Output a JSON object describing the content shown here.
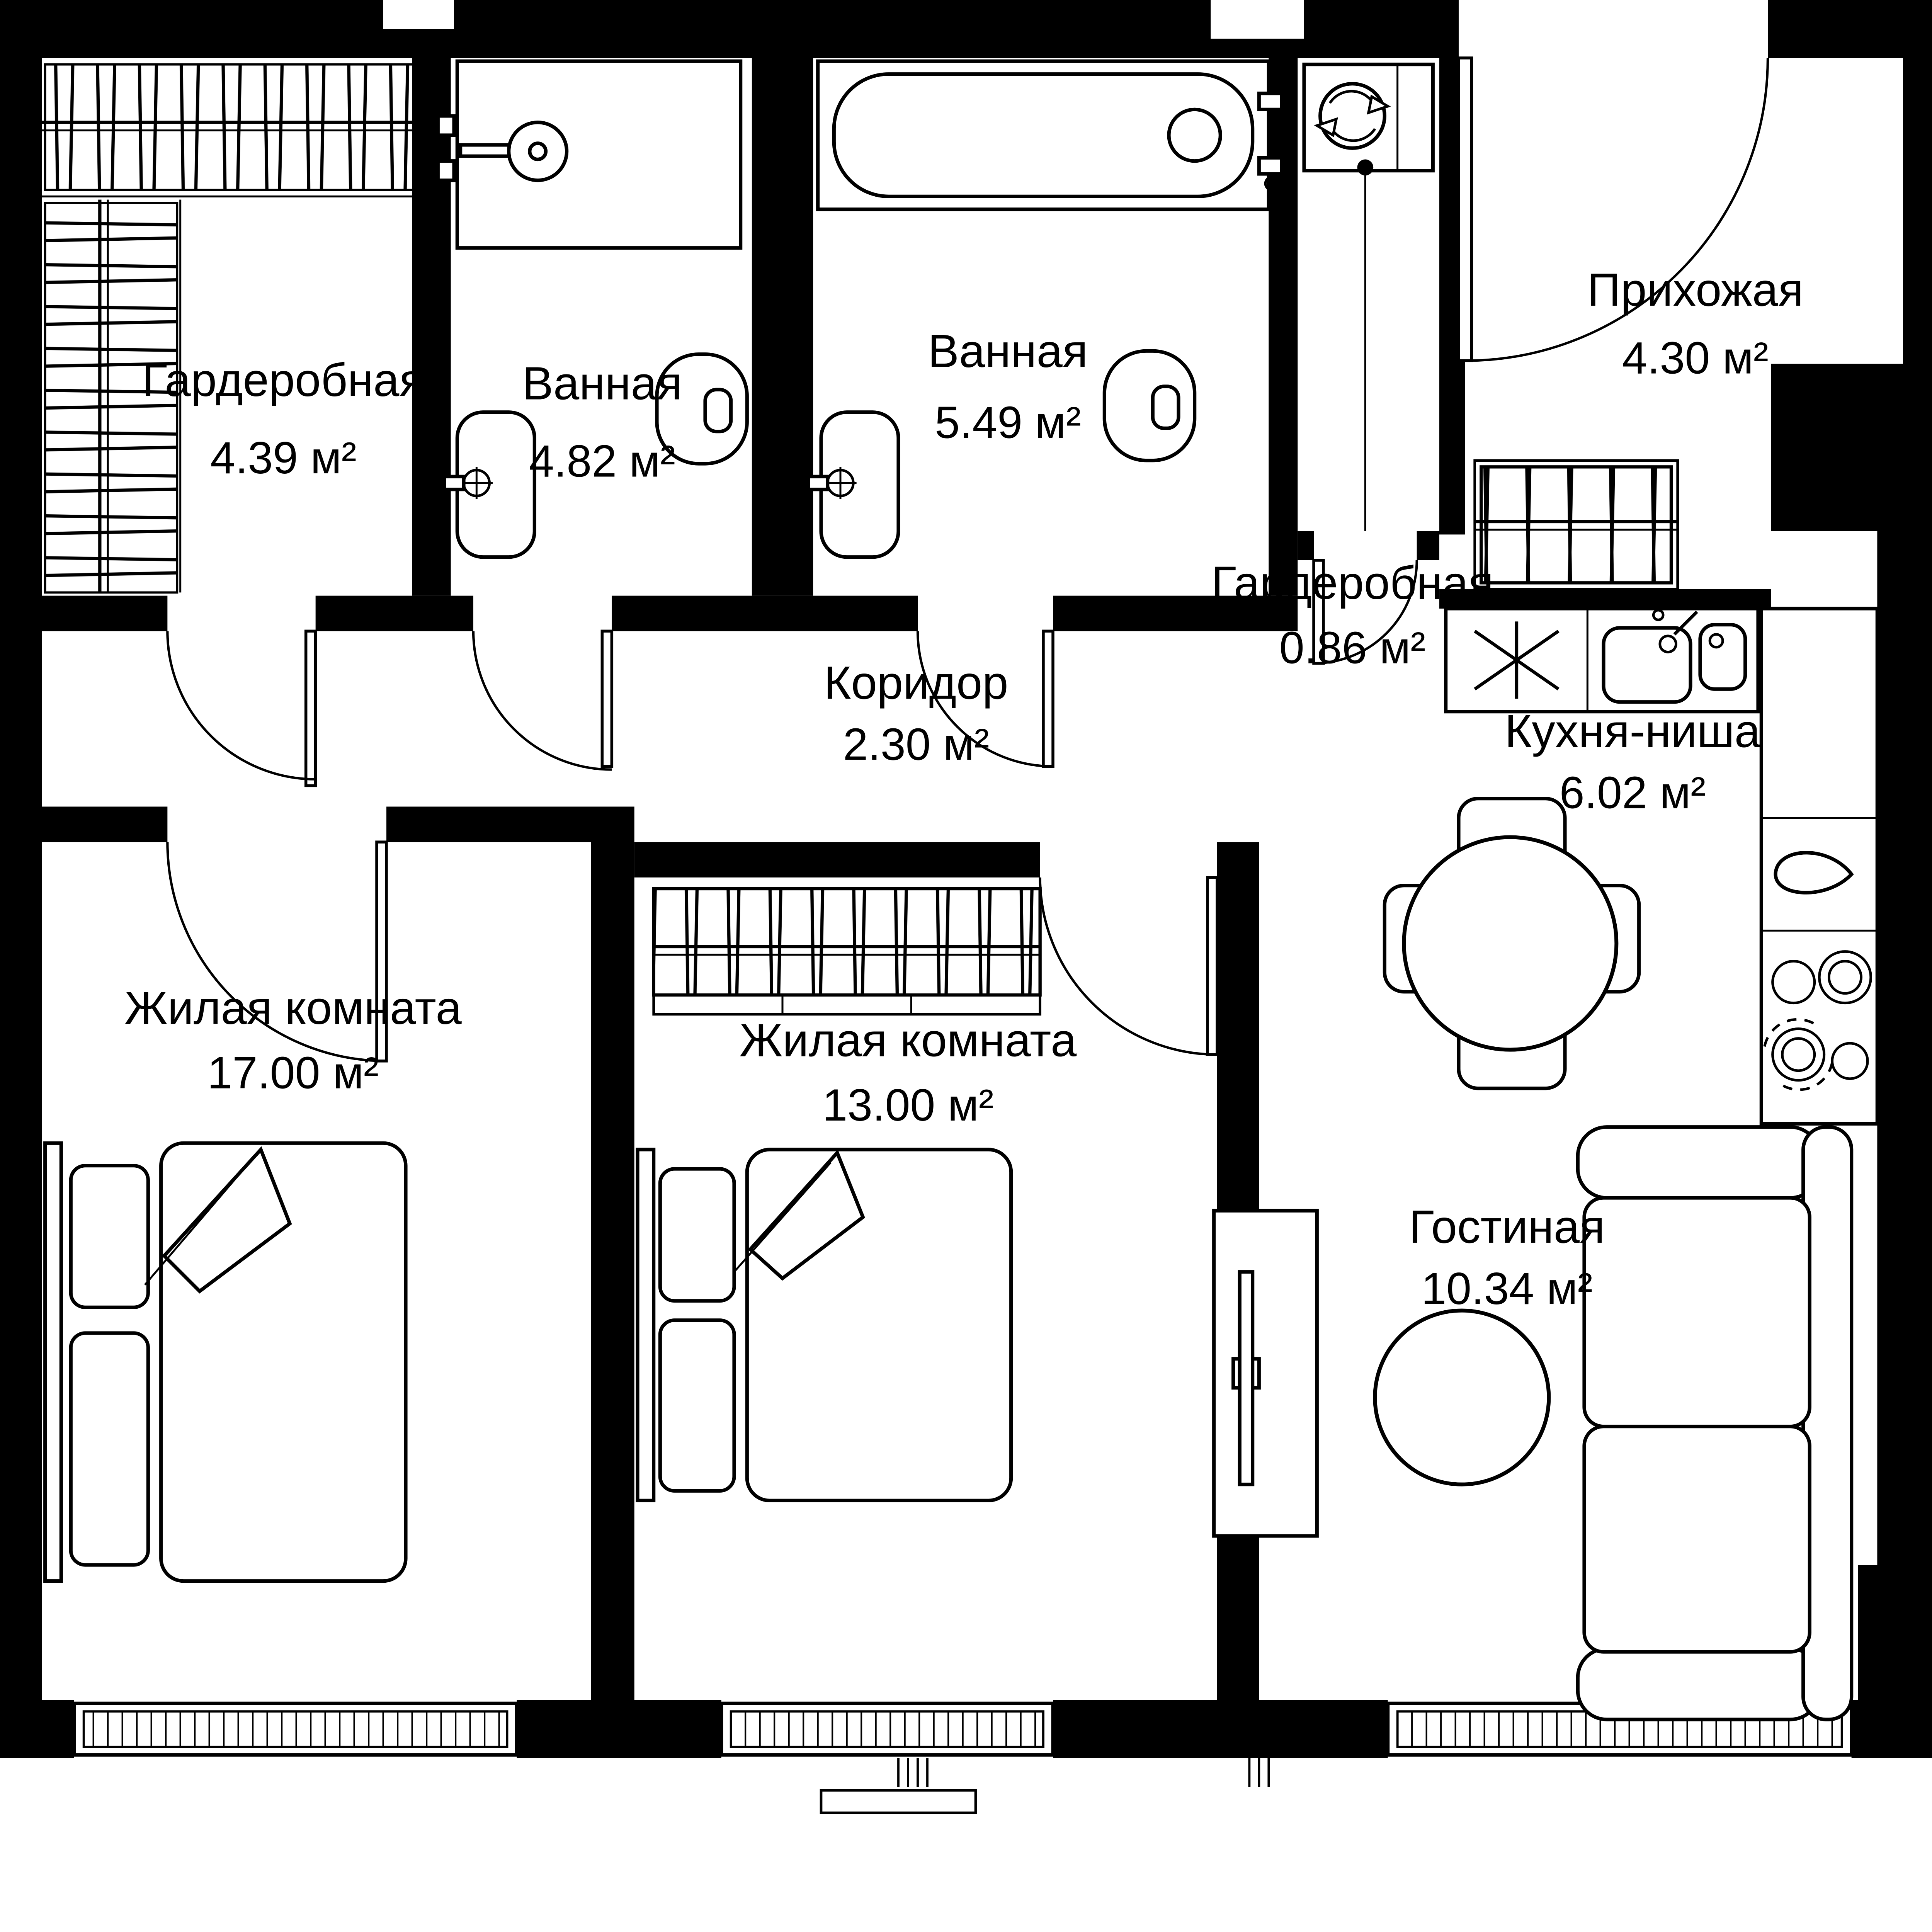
{
  "plan": {
    "type": "apartment-floor-plan",
    "colors": {
      "walls": "#000000",
      "background": "#ffffff",
      "lines": "#000000"
    },
    "rooms": [
      {
        "id": "wardrobe-main",
        "name": "Гардеробная",
        "area": "4.39 м²"
      },
      {
        "id": "bathroom-1",
        "name": "Ванная",
        "area": "4.82 м²"
      },
      {
        "id": "bathroom-2",
        "name": "Ванная",
        "area": "5.49 м²"
      },
      {
        "id": "wardrobe-entry",
        "name": "Гардеробная",
        "area": "0.86 м²"
      },
      {
        "id": "hallway",
        "name": "Прихожая",
        "area": "4.30 м²"
      },
      {
        "id": "corridor",
        "name": "Коридор",
        "area": "2.30 м²"
      },
      {
        "id": "kitchen-niche",
        "name": "Кухня-ниша",
        "area": "6.02 м²"
      },
      {
        "id": "bedroom-1",
        "name": "Жилая комната",
        "area": "17.00 м²"
      },
      {
        "id": "bedroom-2",
        "name": "Жилая комната",
        "area": "13.00 м²"
      },
      {
        "id": "living-room",
        "name": "Гостиная",
        "area": "10.34 м²"
      }
    ],
    "icons": [
      "hanger-rack-icon",
      "shower-icon",
      "sink-icon",
      "toilet-icon",
      "bathtub-icon",
      "washing-machine-icon",
      "fridge-icon",
      "kitchen-sink-icon",
      "stove-icon",
      "kettle-icon",
      "dining-table-icon",
      "chair-icon",
      "double-bed-icon",
      "nightstand-icon",
      "tv-stand-icon",
      "coffee-table-icon",
      "sofa-icon",
      "door-swing-icon",
      "window-icon"
    ]
  }
}
